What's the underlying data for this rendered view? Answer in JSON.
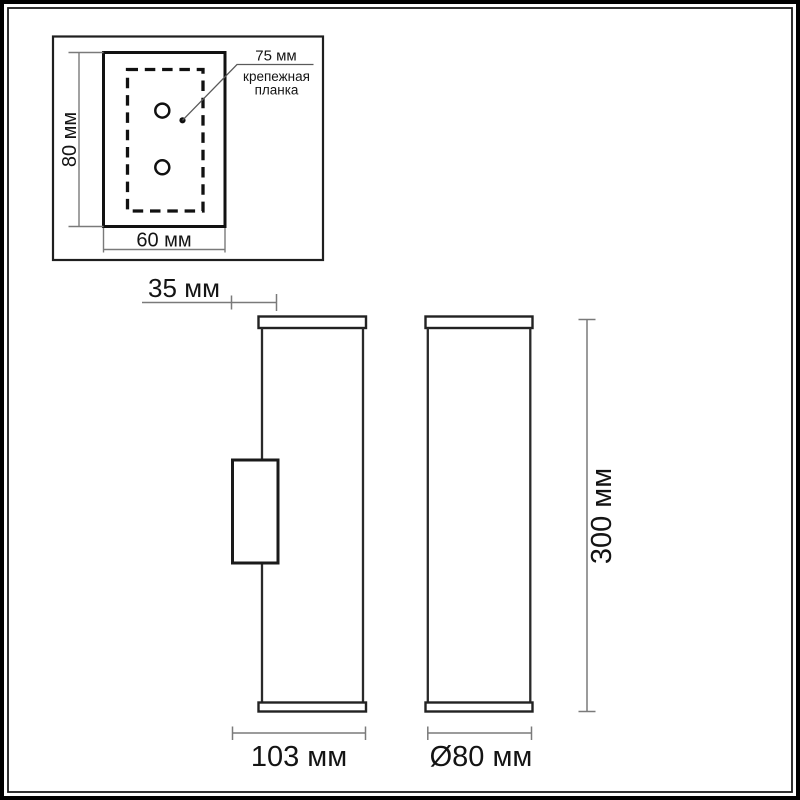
{
  "diagram": {
    "title": "wall lamp dimensional drawing",
    "inset": {
      "height_label": "80 мм",
      "width_label": "60 мм",
      "holes_spacing_label": "75 мм",
      "bracket_caption_line1": "крепежная",
      "bracket_caption_line2": "планка"
    },
    "side_view": {
      "wall_offset_label": "35 мм",
      "depth_label": "103 мм"
    },
    "front_view": {
      "diameter_label": "Ø80 мм",
      "height_label": "300 мм"
    },
    "colors": {
      "background": "#ffffff",
      "object_line": "#1c1c1c",
      "dimension_line": "#7a7a7a",
      "text": "#141414"
    }
  }
}
